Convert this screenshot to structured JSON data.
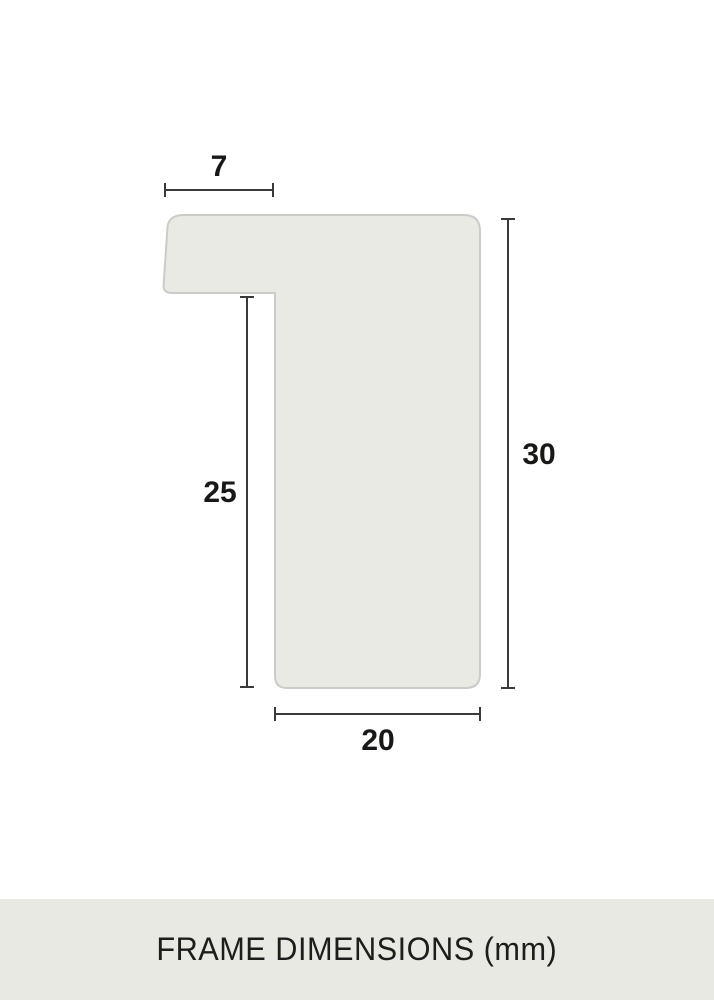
{
  "diagram": {
    "unit": "mm",
    "dimensions": {
      "rebate_width": "7",
      "rebate_height": "25",
      "profile_height": "30",
      "profile_width": "20"
    },
    "colors": {
      "profile_fill": "#e9eae4",
      "profile_stroke": "#cbccc6",
      "dimension_line": "#3a3a3a",
      "label_text": "#181816",
      "footer_band": "#e8e9e3",
      "background": "#ffffff"
    }
  },
  "footer": {
    "title": "FRAME DIMENSIONS (mm)"
  }
}
